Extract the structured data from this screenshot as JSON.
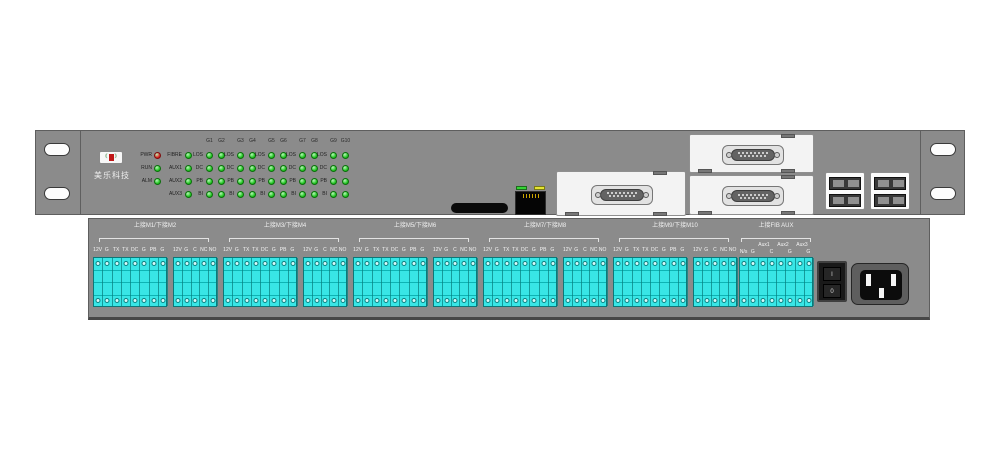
{
  "front": {
    "brand": "美乐科技",
    "leds": {
      "group_headers": [
        "G1",
        "G2",
        "G3",
        "G4",
        "G5",
        "G6",
        "G7",
        "G8",
        "G9",
        "G10"
      ],
      "rows": [
        {
          "status": "PWR",
          "status_color": "#d81f1f",
          "aux": "FIBRE",
          "ch": "LOS"
        },
        {
          "status": "RUN",
          "status_color": "#1fc41f",
          "aux": "AUX1",
          "ch": "DC"
        },
        {
          "status": "ALM",
          "status_color": "#1fc41f",
          "aux": "AUX2",
          "ch": "PB"
        },
        {
          "status": "",
          "status_color": "",
          "aux": "AUX3",
          "ch": "BI"
        }
      ],
      "on_color": "#1fc41f"
    }
  },
  "rear": {
    "sections": [
      {
        "title": "上接M1/下接M2",
        "block_a": [
          "12V",
          "G",
          "TX",
          "TX",
          "DC",
          "G",
          "PB",
          "G"
        ],
        "block_b": [
          "12V",
          "G",
          "C",
          "NC",
          "NO"
        ]
      },
      {
        "title": "上接M3/下接M4",
        "block_a": [
          "12V",
          "G",
          "TX",
          "TX",
          "DC",
          "G",
          "PB",
          "G"
        ],
        "block_b": [
          "12V",
          "G",
          "C",
          "NC",
          "NO"
        ]
      },
      {
        "title": "上接M5/下接M6",
        "block_a": [
          "12V",
          "G",
          "TX",
          "TX",
          "DC",
          "G",
          "PB",
          "G"
        ],
        "block_b": [
          "12V",
          "G",
          "C",
          "NC",
          "NO"
        ]
      },
      {
        "title": "上接M7/下接M8",
        "block_a": [
          "12V",
          "G",
          "TX",
          "TX",
          "DC",
          "G",
          "PB",
          "G"
        ],
        "block_b": [
          "12V",
          "G",
          "C",
          "NC",
          "NO"
        ]
      },
      {
        "title": "上接M9/下接M10",
        "block_a": [
          "12V",
          "G",
          "TX",
          "TX",
          "DC",
          "G",
          "PB",
          "G"
        ],
        "block_b": [
          "12V",
          "G",
          "C",
          "NC",
          "NO"
        ]
      },
      {
        "title": "上接FIB AUX",
        "aux_headers": [
          "Aux1",
          "Aux2",
          "Aux3"
        ],
        "block_a": [
          "N/s",
          "G",
          "",
          "C",
          "",
          "G",
          "",
          "G"
        ]
      }
    ],
    "power_switch": {
      "on_label": "I",
      "off_label": "0"
    }
  },
  "colors": {
    "panel_gray": "#8b8b8b",
    "terminal_cyan": "#38e6e6",
    "led_green": "#1fc41f",
    "led_red": "#d81f1f",
    "plate_white": "#f3f3f3"
  }
}
